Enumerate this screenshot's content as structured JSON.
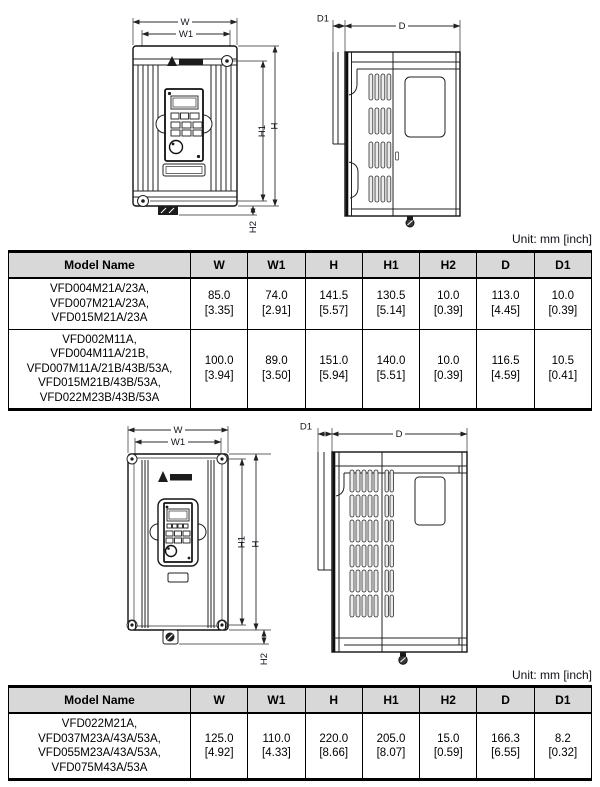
{
  "dims": {
    "w": "W",
    "w1": "W1",
    "h": "H",
    "h1": "H1",
    "h2": "H2",
    "d": "D",
    "d1": "D1"
  },
  "icons": {
    "logo": "delta-logo"
  },
  "tables": [
    {
      "unit_label": "Unit: mm [inch]",
      "headers": [
        "Model Name",
        "W",
        "W1",
        "H",
        "H1",
        "H2",
        "D",
        "D1"
      ],
      "rows": [
        {
          "model_lines": [
            "VFD004M21A/23A,",
            "VFD007M21A/23A,",
            "VFD015M21A/23A"
          ],
          "cells": [
            {
              "mm": "85.0",
              "inch": "[3.35]"
            },
            {
              "mm": "74.0",
              "inch": "[2.91]"
            },
            {
              "mm": "141.5",
              "inch": "[5.57]"
            },
            {
              "mm": "130.5",
              "inch": "[5.14]"
            },
            {
              "mm": "10.0",
              "inch": "[0.39]"
            },
            {
              "mm": "113.0",
              "inch": "[4.45]"
            },
            {
              "mm": "10.0",
              "inch": "[0.39]"
            }
          ]
        },
        {
          "model_lines": [
            "VFD002M11A,",
            "VFD004M11A/21B,",
            "VFD007M11A/21B/43B/53A,",
            "VFD015M21B/43B/53A,",
            "VFD022M23B/43B/53A"
          ],
          "cells": [
            {
              "mm": "100.0",
              "inch": "[3.94]"
            },
            {
              "mm": "89.0",
              "inch": "[3.50]"
            },
            {
              "mm": "151.0",
              "inch": "[5.94]"
            },
            {
              "mm": "140.0",
              "inch": "[5.51]"
            },
            {
              "mm": "10.0",
              "inch": "[0.39]"
            },
            {
              "mm": "116.5",
              "inch": "[4.59]"
            },
            {
              "mm": "10.5",
              "inch": "[0.41]"
            }
          ]
        }
      ]
    },
    {
      "unit_label": "Unit: mm [inch]",
      "headers": [
        "Model Name",
        "W",
        "W1",
        "H",
        "H1",
        "H2",
        "D",
        "D1"
      ],
      "rows": [
        {
          "model_lines": [
            "VFD022M21A,",
            "VFD037M23A/43A/53A,",
            "VFD055M23A/43A/53A,",
            "VFD075M43A/53A"
          ],
          "cells": [
            {
              "mm": "125.0",
              "inch": "[4.92]"
            },
            {
              "mm": "110.0",
              "inch": "[4.33]"
            },
            {
              "mm": "220.0",
              "inch": "[8.66]"
            },
            {
              "mm": "205.0",
              "inch": "[8.07]"
            },
            {
              "mm": "15.0",
              "inch": "[0.59]"
            },
            {
              "mm": "166.3",
              "inch": "[6.55]"
            },
            {
              "mm": "8.2",
              "inch": "[0.32]"
            }
          ]
        }
      ]
    }
  ]
}
